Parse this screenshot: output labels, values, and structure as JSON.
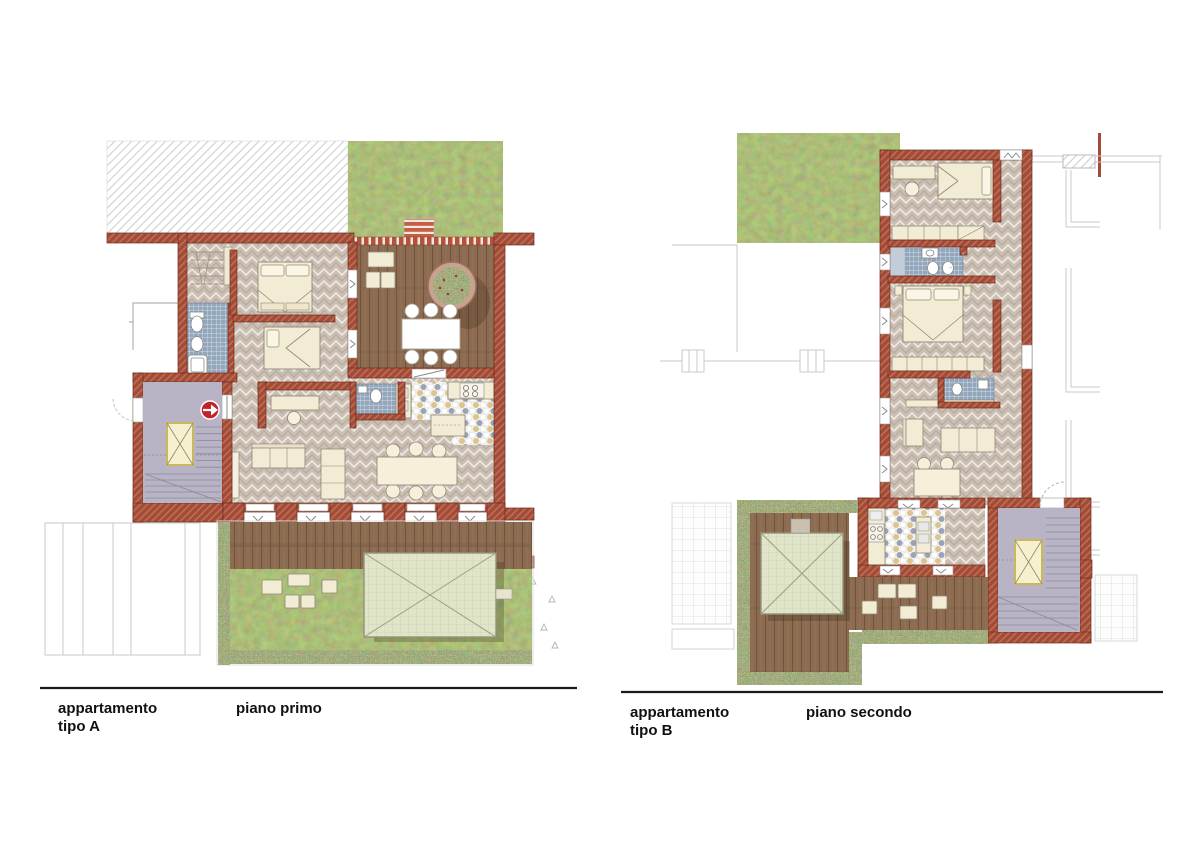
{
  "page": {
    "background": "#ffffff"
  },
  "captions": {
    "plan_a": {
      "apartment": "appartamento",
      "type": "tipo A",
      "floor": "piano primo"
    },
    "plan_b": {
      "apartment": "appartamento",
      "type": "tipo B",
      "floor": "piano secondo"
    }
  },
  "icons": {
    "entrance_marker": "arrow-right"
  },
  "colors": {
    "wall_brick": "#a24b36",
    "wall_hatch": "#c0705a",
    "floor_herringbone": "#cbbfb3",
    "deck_wood": "#8c6b51",
    "grass": "#7b8f51",
    "flower_border": "#8a9a62",
    "bath_tile_blue": "#92a6bc",
    "kitchen_tile_slate": "#9aa2b6",
    "kitchen_tile_tan": "#dcc48f",
    "stair_core": "#b8b4c6",
    "elevator": "#f6f0cf",
    "elevator_frame": "#c8ba5c",
    "furniture_cream": "#f3ecd4",
    "gazebo_canopy": "#e0e4c9",
    "entrance_marker_red": "#c2232b",
    "outline_gray": "#c9c9c9",
    "caption_text": "#111111",
    "divider_line": "#1a1a1a"
  }
}
